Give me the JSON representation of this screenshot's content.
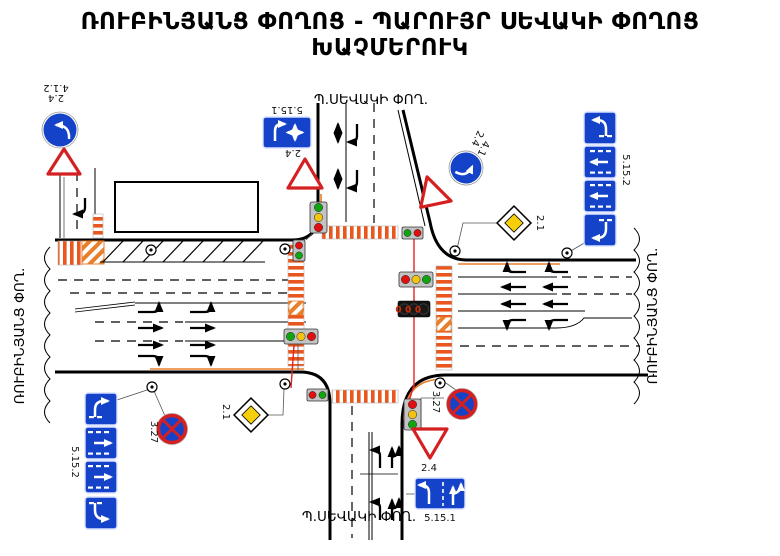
{
  "title": {
    "line1": "ՌՈՒԲԻՆՅԱՆՑ ՓՈՂՈՑ - ՊԱՐՈՒՅՐ ՍԵՎԱԿԻ ՓՈՂՈՑ",
    "line2": "ԽԱՉՄԵՐՈՒԿ"
  },
  "streets": {
    "north": "Պ.ՍԵՎԱԿԻ ՓՈՂ.",
    "south": "Պ.ՍԵՎԱԿԻ ՓՈՂ.",
    "west": "ՌՈՒԲԻՆՅԱՆՑ ՓՈՂ.",
    "east": "ՌՈՒԲԻՆՅԱՆՑ ՓՈՂ."
  },
  "codes": {
    "mandatory_direction": "4.1.2",
    "yield": "2.4",
    "priority_road": "2.1",
    "no_stopping": "3.27",
    "lane_sign": "5.15.1",
    "lane_sign_stack": "5.15.2"
  },
  "traffic_light": {
    "countdown": "000"
  },
  "colors": {
    "sign_blue": "#1442c8",
    "sign_red": "#d42020",
    "priority_yellow": "#f4cf0a",
    "crosswalk": "#e8571d",
    "hatch_orange": "#e87f2a",
    "light_red": "#e01010",
    "light_yellow": "#f2c410",
    "light_green": "#11a411",
    "cable_red": "#e32222",
    "housing_gray": "#c3c3c3",
    "countdown_bg": "#121212",
    "countdown_digit": "#cc2e00"
  }
}
